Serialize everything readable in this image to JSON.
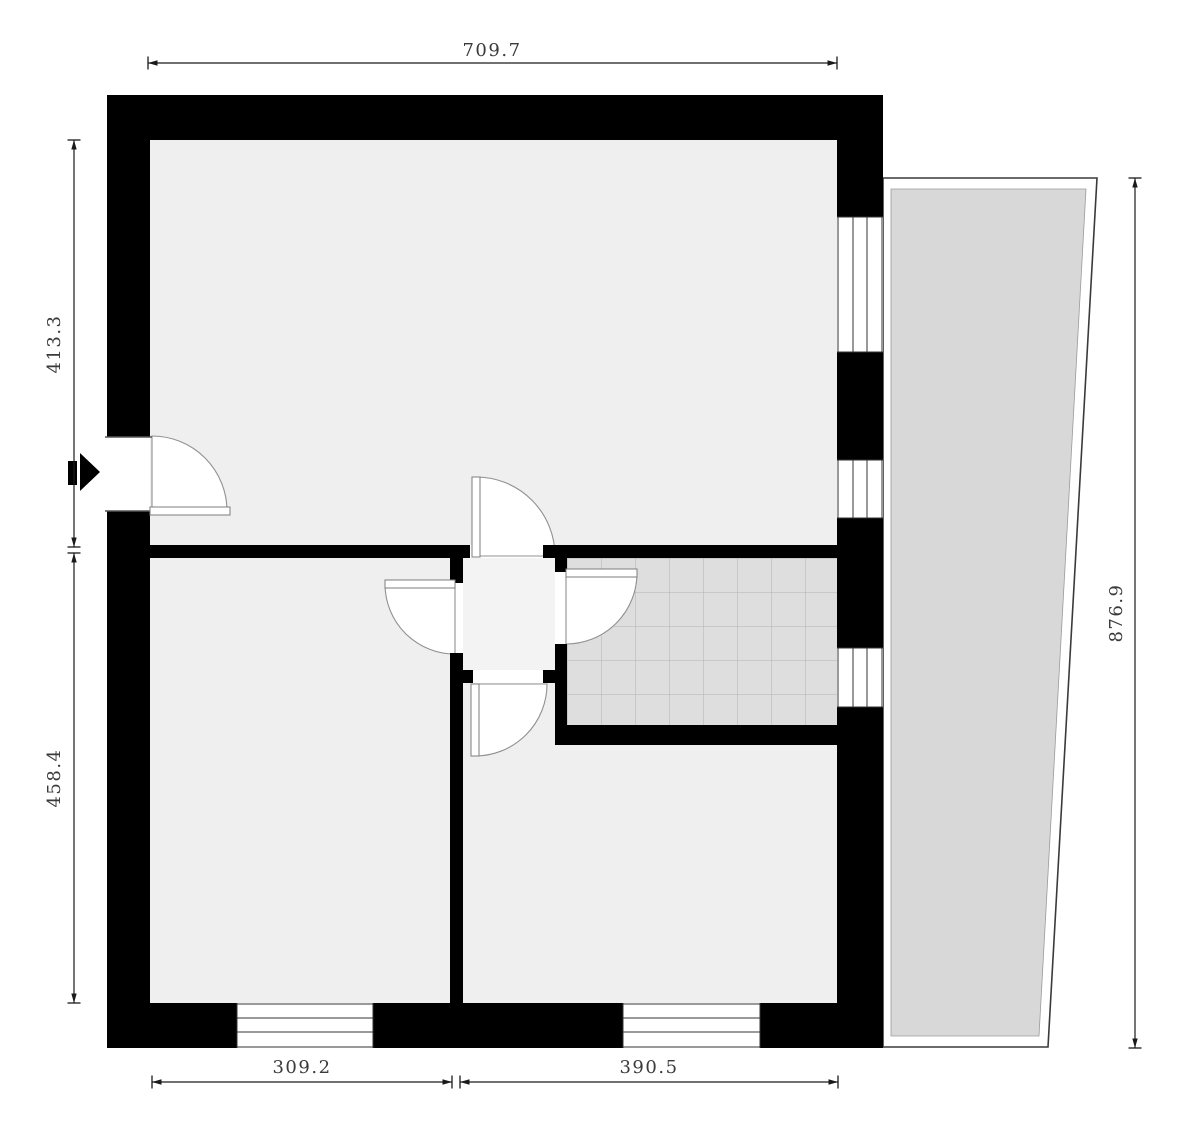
{
  "plan": {
    "type": "architectural-floor-plan",
    "dimensions": {
      "top_width": "709.7",
      "left_upper_height": "413.3",
      "left_lower_height": "458.4",
      "right_height": "876.9",
      "bottom_left_width": "309.2",
      "bottom_right_width": "390.5"
    },
    "colors": {
      "wall": "#000000",
      "floor": "#efefef",
      "hall_floor": "#f3f3f3",
      "tile_floor": "#dedede",
      "tile_grid": "#b2b2b2",
      "balcony_fill": "#d8d8d8",
      "door_arc": "#909090",
      "dimension_line": "#1a1a1a",
      "dimension_text": "#3a3a3a"
    }
  }
}
